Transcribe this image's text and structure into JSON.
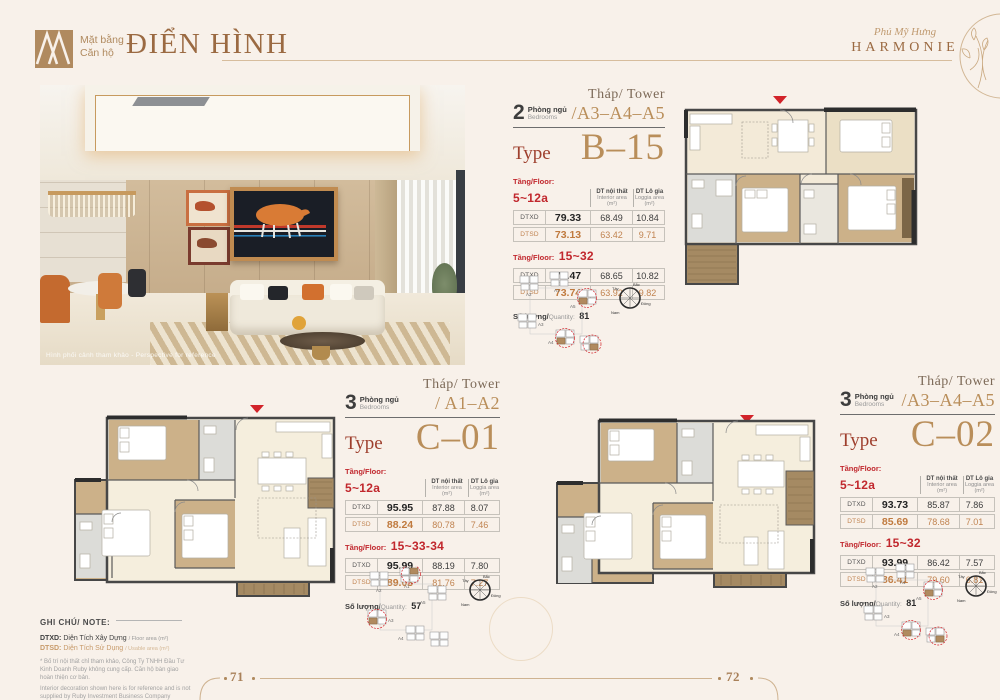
{
  "header": {
    "section_vi_1": "Mặt bằng",
    "section_vi_2": "Căn hộ",
    "section_title": "ĐIỂN HÌNH",
    "brand_script": "Phú Mỹ Hưng",
    "brand_name": "HARMONIE"
  },
  "photo": {
    "caption": "Hình phối cảnh tham khảo - Perspective for reference"
  },
  "labels": {
    "tower": "Tháp/ Tower",
    "type": "Type",
    "bedrooms_vi": "Phòng ngủ",
    "bedrooms_en": "Bedrooms",
    "floor": "Tầng/Floor:",
    "col1_vi": "DT nội thất",
    "col1_en": "Interior area",
    "col1_unit": "(m²)",
    "col2_vi": "DT Lô gia",
    "col2_en": "Loggia area",
    "col2_unit": "(m²)",
    "dtxd": "DTXD",
    "dtsd": "DTSD",
    "qty_vi": "Số lượng/",
    "qty_en": "Quantity:"
  },
  "units": {
    "b15": {
      "bedrooms": "2",
      "towers": "/A3–A4–A5",
      "type_name": "B–15",
      "floors1": "5~12a",
      "g1_dtxd": [
        "79.33",
        "68.49",
        "10.84"
      ],
      "g1_dtsd": [
        "73.13",
        "63.42",
        "9.71"
      ],
      "floors2": "15~32",
      "g2_dtxd": [
        "79.47",
        "68.65",
        "10.82"
      ],
      "g2_dtsd": [
        "73.74",
        "63.92",
        "9.82"
      ],
      "qty": "81"
    },
    "c01": {
      "bedrooms": "3",
      "towers": "/ A1–A2",
      "type_name": "C–01",
      "floors1": "5~12a",
      "g1_dtxd": [
        "95.95",
        "87.88",
        "8.07"
      ],
      "g1_dtsd": [
        "88.24",
        "80.78",
        "7.46"
      ],
      "floors2": "15~33-34",
      "g2_dtxd": [
        "95.99",
        "88.19",
        "7.80"
      ],
      "g2_dtsd": [
        "89.03",
        "81.76",
        "7.27"
      ],
      "qty": "57"
    },
    "c02": {
      "bedrooms": "3",
      "towers": "/A3–A4–A5",
      "type_name": "C–02",
      "floors1": "5~12a",
      "g1_dtxd": [
        "93.73",
        "85.87",
        "7.86"
      ],
      "g1_dtsd": [
        "85.69",
        "78.68",
        "7.01"
      ],
      "floors2": "15~32",
      "g2_dtxd": [
        "93.99",
        "86.42",
        "7.57"
      ],
      "g2_dtsd": [
        "86.41",
        "79.60",
        "6.81"
      ],
      "qty": "81"
    }
  },
  "compass": {
    "n": "Bắc",
    "s": "Nam",
    "e": "Đông",
    "w": "Tây"
  },
  "keyplan": {
    "a1": "A1",
    "a2": "A2",
    "a3": "A3",
    "a4": "A4",
    "a5": "A5"
  },
  "note": {
    "title": "GHI CHÚ/ NOTE:",
    "dtxd_label": "DTXD:",
    "dtxd_vi": "Diện Tích Xây Dựng",
    "dtxd_en": "/ Floor area (m²)",
    "dtsd_label": "DTSD:",
    "dtsd_vi": "Diện Tích Sử Dụng",
    "dtsd_en": "/ Usable area (m²)",
    "disclaimer_vi": "* Bố trí nội thất chỉ tham khảo, Công Ty TNHH Đầu Tư Kinh Doanh Ruby không cung cấp. Căn hộ bàn giao hoàn thiện cơ bản.",
    "disclaimer_en": "Interior decoration shown here is for reference and is not supplied by Ruby Investment Business Company Limited. The apartments are standard - style handover."
  },
  "footer": {
    "page_left": "71",
    "page_right": "72"
  }
}
